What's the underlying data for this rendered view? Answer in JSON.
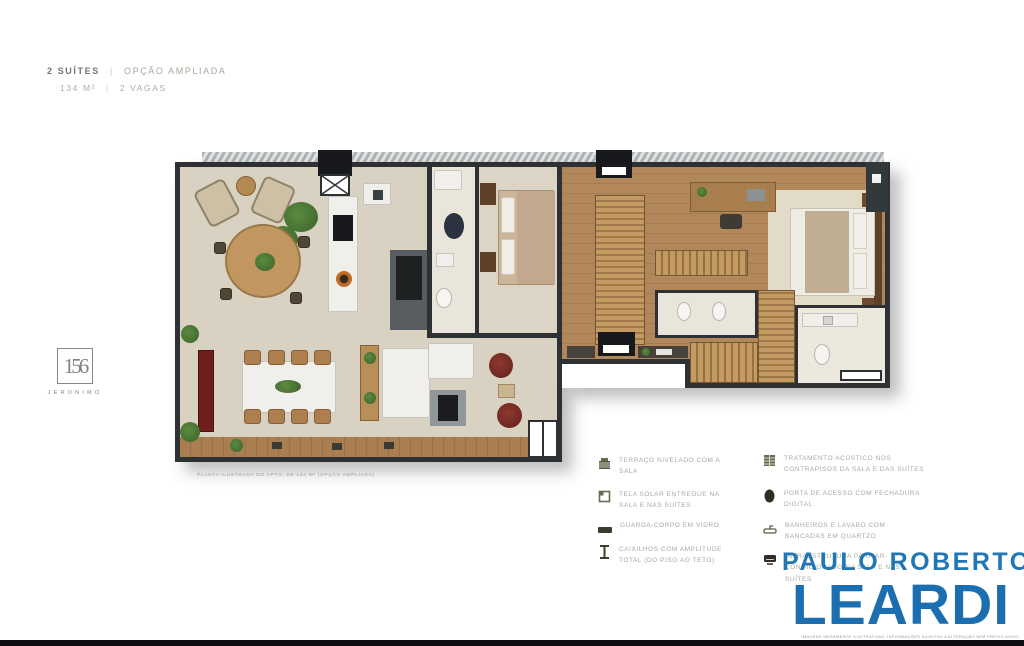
{
  "header": {
    "title_primary": "2 SUÍTES",
    "title_separator": "|",
    "title_secondary": "OPÇÃO AMPLIADA",
    "specs_area": "134 M²",
    "specs_separator": "|",
    "specs_parking": "2 VAGAS"
  },
  "side_logo": {
    "number": "156",
    "name": "JERONIMO"
  },
  "floorplan": {
    "caption": "PLANTA ILUSTRADA DO APTO. DE 134 M² (OPÇÃO AMPLIADA)"
  },
  "legend": {
    "left": [
      {
        "icon": "deck-leveled-icon",
        "text": "TERRAÇO NIVELADO COM A SALA"
      },
      {
        "icon": "solar-screen-icon",
        "text": "TELA SOLAR ENTREGUE NA SALA E NAS SUÍTES"
      },
      {
        "icon": "glass-guardrail-icon",
        "text": "GUARDA-CORPO EM VIDRO"
      },
      {
        "icon": "window-frame-icon",
        "text": "CAIXILHOS COM AMPLITUDE TOTAL (DO PISO AO TETO)"
      }
    ],
    "right": [
      {
        "icon": "acoustic-treatment-icon",
        "text": "TRATAMENTO ACÚSTICO NOS CONTRAPISOS DA SALA E DAS SUÍTES"
      },
      {
        "icon": "digital-lock-icon",
        "text": "PORTA DE ACESSO COM FECHADURA DIGITAL"
      },
      {
        "icon": "quartz-countertop-icon",
        "text": "BANHEIROS E LAVABO COM BANCADAS EM QUARTZO"
      },
      {
        "icon": "air-conditioning-icon",
        "text": "INFRAESTRUTURA PARA AR-CONDICIONADO NA SALA E NAS SUÍTES"
      }
    ]
  },
  "brand": {
    "name_top": "PAULO ROBERTO",
    "name_bottom": "LEARDI",
    "disclaimer": "IMAGENS MERAMENTE ILUSTRATIVAS. INFORMAÇÕES SUJEITAS A ALTERAÇÃO SEM PRÉVIO AVISO.",
    "color": "#1d6fae"
  },
  "colors": {
    "brand_blue": "#1d6fae",
    "wall": "#2d3134",
    "floor_beige": "#d9d2c2",
    "wood": "#b5895c",
    "accent_green": "#4d7a35",
    "legend_text": "#a6aba0",
    "footer_bar": "#0e0e14"
  }
}
